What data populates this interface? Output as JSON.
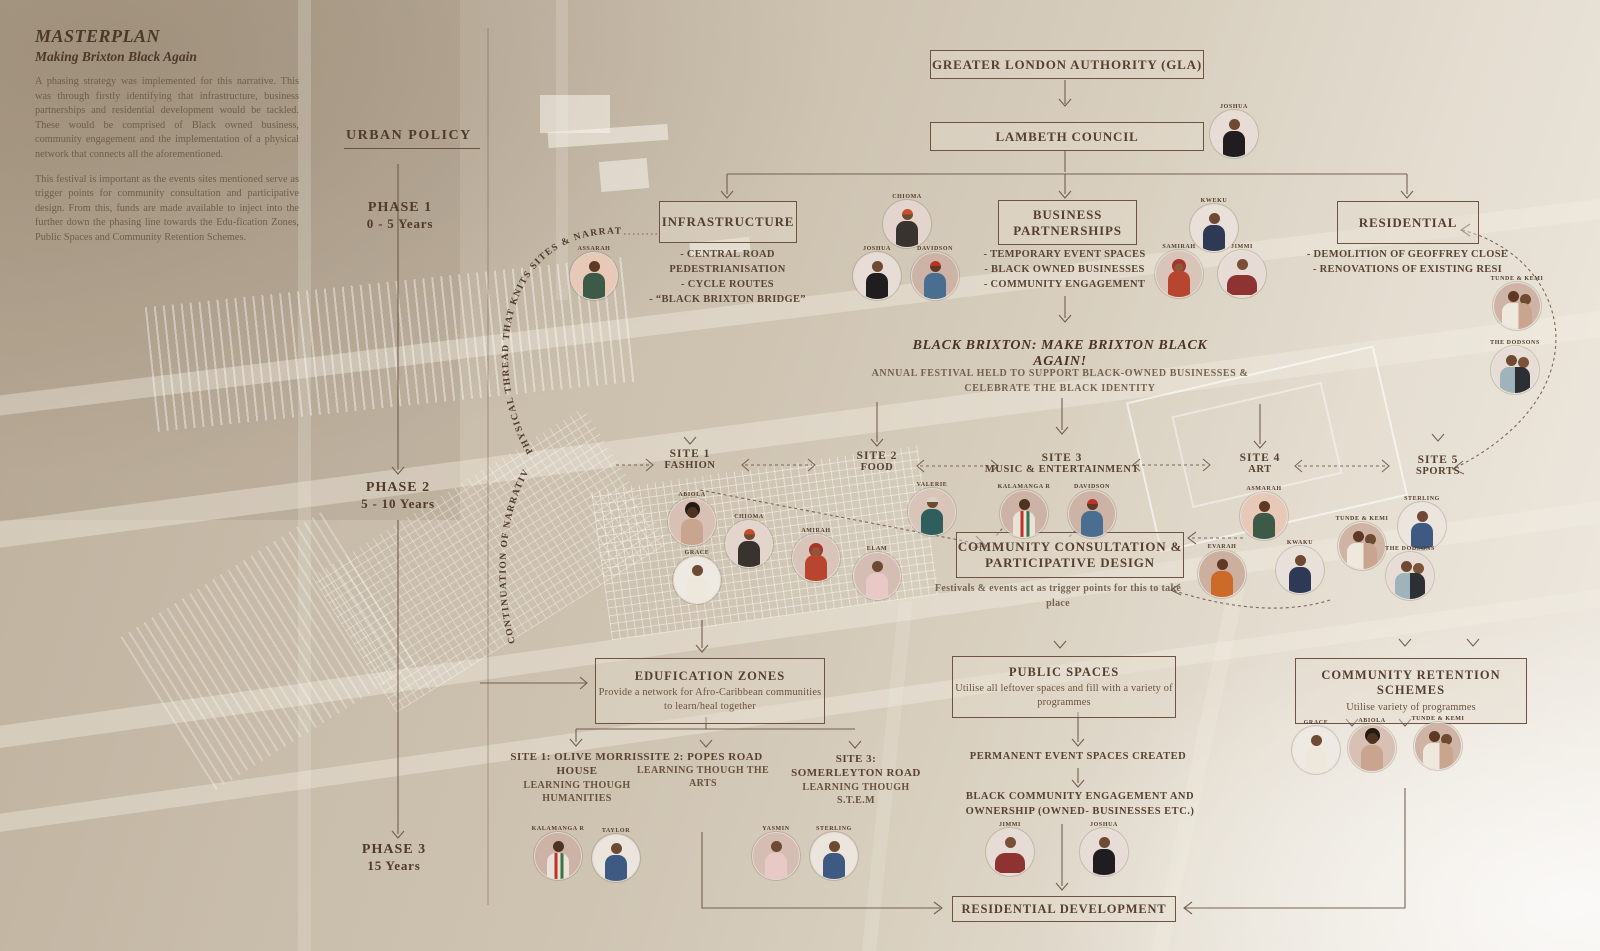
{
  "masthead": {
    "title": "MASTERPLAN",
    "subtitle": "Making Brixton Black Again",
    "para1": "A phasing strategy was implemented for this narrative. This was through firstly identifying that infrastructure, business partnerships and residential development would be tackled. These would be comprised of Black owned business, community engagement and the implementation of a physical network that connects all the aforementioned.",
    "para2": "This festival is important as the events sites mentioned serve as trigger points for community consultation and participative design. From this, funds are made available to inject into the further down the phasing line towards the Edu-fication Zones, Public Spaces and Community Retention Schemes."
  },
  "policy_label": "URBAN POLICY",
  "phases": [
    {
      "name": "PHASE 1",
      "years": "0 - 5 Years"
    },
    {
      "name": "PHASE 2",
      "years": "5 - 10 Years"
    },
    {
      "name": "PHASE 3",
      "years": "15 Years"
    }
  ],
  "governance": {
    "gla": "GREATER LONDON AUTHORITY (GLA)",
    "council": "LAMBETH COUNCIL"
  },
  "streams": {
    "infrastructure": {
      "title": "INFRASTRUCTURE",
      "item1": "- CENTRAL ROAD PEDESTRIANISATION",
      "item2": "- CYCLE ROUTES",
      "item3": "- “BLACK BRIXTON BRIDGE”"
    },
    "business": {
      "title": "BUSINESS PARTNERSHIPS",
      "item1": "- TEMPORARY EVENT SPACES",
      "item2": "- BLACK OWNED BUSINESSES",
      "item3": "- COMMUNITY ENGAGEMENT"
    },
    "residential": {
      "title": "RESIDENTIAL",
      "item1": "- DEMOLITION OF GEOFFREY CLOSE",
      "item2": "- RENOVATIONS OF EXISTING RESI"
    }
  },
  "festival": {
    "headline": "BLACK BRIXTON: MAKE BRIXTON BLACK AGAIN!",
    "subtext": "ANNUAL FESTIVAL HELD TO SUPPORT BLACK-OWNED BUSINESSES & CELEBRATE THE BLACK IDENTITY"
  },
  "sites": [
    {
      "id": "SITE 1",
      "name": "FASHION"
    },
    {
      "id": "SITE 2",
      "name": "FOOD"
    },
    {
      "id": "SITE 3",
      "name": "MUSIC & ENTERTAINMENT"
    },
    {
      "id": "SITE 4",
      "name": "ART"
    },
    {
      "id": "SITE 5",
      "name": "SPORTS"
    }
  ],
  "consultation": {
    "title": "COMMUNITY CONSULTATION & PARTICIPATIVE DESIGN",
    "note": "Festivals & events act as trigger points for this to take place"
  },
  "zones": {
    "edufication": {
      "title": "EDUFICATION ZONES",
      "desc": "Provide a network for Afro-Caribbean communities to learn/heal together"
    },
    "public": {
      "title": "PUBLIC SPACES",
      "desc": "Utilise all leftover spaces and fill with a variety of programmes"
    },
    "retention": {
      "title": "COMMUNITY RETENTION SCHEMES",
      "desc": "Utilise variety of programmes"
    }
  },
  "learning_sites": [
    {
      "name": "SITE 1: OLIVE MORRIS HOUSE",
      "method": "LEARNING THOUGH HUMANITIES"
    },
    {
      "name": "SITE 2: POPES ROAD",
      "method": "LEARNING THOUGH THE ARTS"
    },
    {
      "name": "SITE 3: SOMERLEYTON ROAD",
      "method": "LEARNING THOUGH S.T.E.M"
    }
  ],
  "outcomes": {
    "permanent": "PERMANENT EVENT SPACES CREATED",
    "ownership": "BLACK COMMUNITY ENGAGEMENT AND OWNERSHIP (OWNED- BUSINESSES ETC.)",
    "residential": "RESIDENTIAL DEVELOPMENT"
  },
  "threads": {
    "physical": "PHYSICAL THREAD THAT KNITS SITES & NARRATIVE.......",
    "continuation": "CONTINUATION OF NARRATIVE"
  },
  "people": [
    {
      "name": "ASSARAH"
    },
    {
      "name": "JOSHUA"
    },
    {
      "name": "CHIOMA"
    },
    {
      "name": "JOSHUA"
    },
    {
      "name": "DAVIDSON"
    },
    {
      "name": "KWEKU"
    },
    {
      "name": "SAMIRAH"
    },
    {
      "name": "JIMMI"
    },
    {
      "name": "TUNDE & KEMI"
    },
    {
      "name": "THE DODSONS"
    },
    {
      "name": "ABIOLA"
    },
    {
      "name": "CHIOMA"
    },
    {
      "name": "GRACE"
    },
    {
      "name": "AMIRAH"
    },
    {
      "name": "ELAM"
    },
    {
      "name": "VALERIE"
    },
    {
      "name": "KALAMANGA R"
    },
    {
      "name": "DAVIDSON"
    },
    {
      "name": "ASMARAH"
    },
    {
      "name": "EVARAH"
    },
    {
      "name": "KWAKU"
    },
    {
      "name": "TUNDE & KEMI"
    },
    {
      "name": "STERLING"
    },
    {
      "name": "THE DODSONS"
    },
    {
      "name": "GRACE"
    },
    {
      "name": "ABIOLA"
    },
    {
      "name": "TUNDE & KEMI"
    },
    {
      "name": "KALAMANGA R"
    },
    {
      "name": "TAYLOR"
    },
    {
      "name": "YASMIN"
    },
    {
      "name": "STERLING"
    },
    {
      "name": "JIMMI"
    },
    {
      "name": "JOSHUA"
    }
  ],
  "colors": {
    "paper": "#c9bdab",
    "ink": "#5c4536",
    "ink_faded": "#80705c",
    "accent_red": "#b03a2e"
  }
}
